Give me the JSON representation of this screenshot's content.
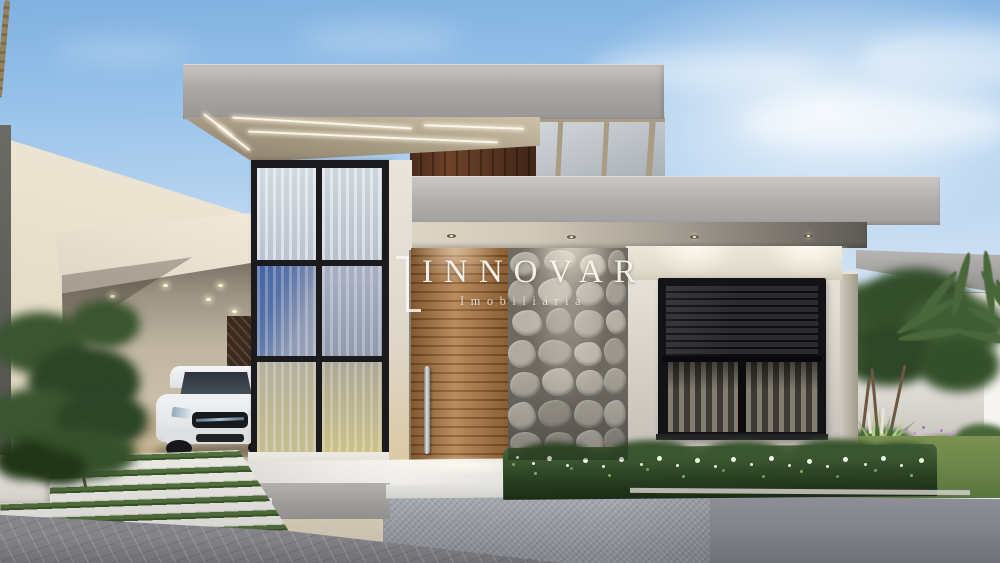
{
  "image_type": "architectural-exterior-render",
  "watermark": {
    "brand": "INNOVAR",
    "tagline": "Imobiliária"
  },
  "scene": {
    "description": "Dusk 3D rendering of a modern flat-roof single-story house with carport, white SUV, double-height glass curtain wall, wood slat entry door, stone feature wall, black roller-shutter window, landscaped garden with palm trees, grass-joint steps and paver driveway.",
    "objects": [
      "sky",
      "clouds",
      "neighbor-wall",
      "main-roof-slab",
      "led-strip-lighting",
      "skylight-panels",
      "secondary-roof-slab",
      "recessed-downlights",
      "glass-curtain-wall",
      "sheer-curtains",
      "carport",
      "white-suv-car",
      "wood-entry-door",
      "steel-door-handle",
      "stone-feature-wall",
      "roller-shutter-window",
      "side-pergola-slab",
      "boundary-wall",
      "garden-trees",
      "palm-tree",
      "agave-plant",
      "flower-hedge",
      "lawn",
      "purple-flowers",
      "entry-steps",
      "grass-joint-steps",
      "planter-wall",
      "paver-driveway",
      "sidewalk",
      "left-tree"
    ],
    "colors": {
      "sky_top": "#81b1e0",
      "sky_horizon": "#f5f8fa",
      "concrete_roof": "#a9a7a5",
      "concrete_white": "#e9e5d9",
      "soffit_tan": "#a2957f",
      "wood_door": "#9c6434",
      "wood_dark": "#4e2e1a",
      "stone_gray": "#a8a399",
      "frame_black": "#1a1a1c",
      "glass_blue": "#4463a0",
      "hedge_green": "#2c4424",
      "lawn_green": "#5d7a40",
      "pavement": "#8e8e93",
      "car_white": "#eef0f2",
      "led_warm_white": "#fff6e1"
    }
  }
}
